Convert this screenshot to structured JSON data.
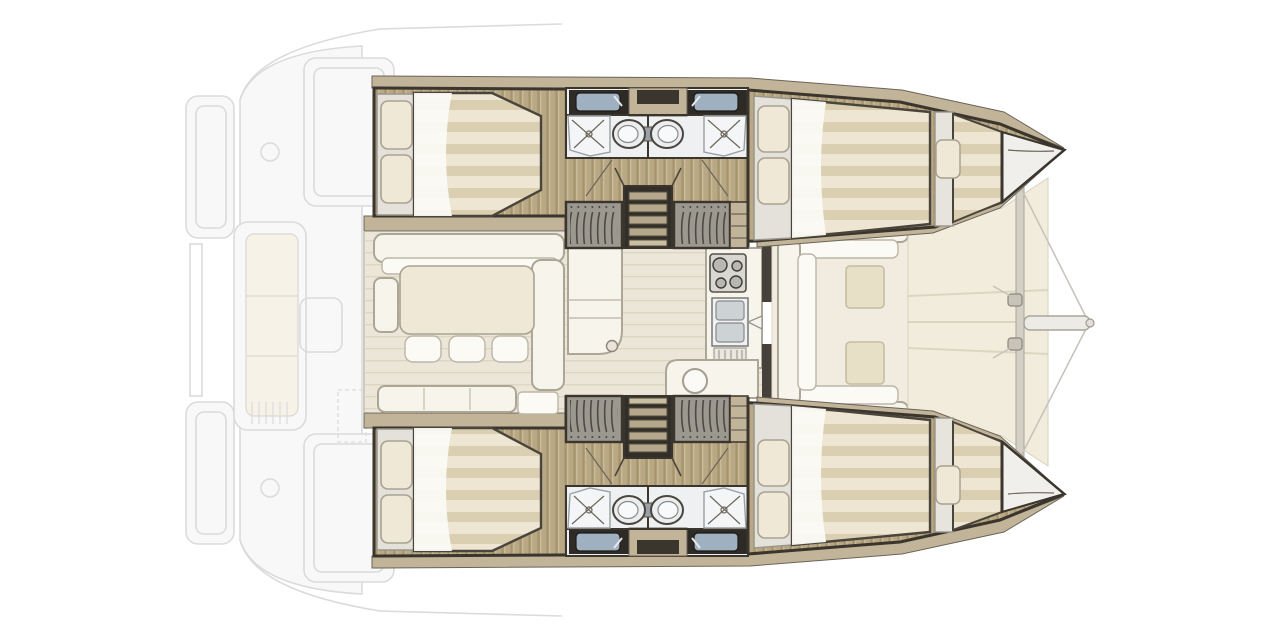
{
  "diagram": {
    "type": "boat floor plan",
    "subject": "sailing catamaran interior layout, overhead view, bow pointing right",
    "rendered_text": [],
    "features": {
      "hulls": [
        {
          "name": "port-hull-top",
          "contents": [
            "aft double cabin",
            "bathroom (sink, toilet, shower)",
            "hanging wardrobes",
            "companionway stairs",
            "forward double cabin",
            "bow berth"
          ]
        },
        {
          "name": "starboard-hull-bottom",
          "contents": [
            "aft double cabin",
            "bathroom (sink, toilet, shower)",
            "hanging wardrobes",
            "companionway stairs",
            "forward double cabin",
            "bow berth"
          ]
        }
      ],
      "bridgedeck": [
        "saloon L-sofa",
        "dining table",
        "three stools",
        "chaise bench",
        "side table",
        "galley island",
        "galley counter with stove, double sink, drainer, faucet",
        "nav seat with round stool"
      ],
      "exterior": [
        "faded aft cockpit deck",
        "transom steps",
        "aft bench with cushions",
        "forward cockpit U-seating with two cushions",
        "trampoline",
        "forward crossbeam",
        "bowsprit",
        "bridle lines"
      ]
    }
  },
  "palette": {
    "outline": "#3a352d",
    "wood": "#b9a885",
    "wood_dark": "#a6946e",
    "deck_tan": "#c2b499",
    "plank_floor": "#ece6d8",
    "cream": "#efe8d6",
    "mattress_light": "#eee6d2",
    "mattress_dark": "#dbcfb2",
    "white_furn": "#f7f4ec",
    "furn_stroke": "#aca696",
    "bath_floor": "#eef0f1",
    "counter_dark": "#2e2a25",
    "basin_blue": "#9fb0c1",
    "fixture_gray": "#ecedef",
    "trampoline": "#f2ecdc",
    "cushion": "#e7dfc6",
    "stairs_dark": "#322e28",
    "wardrobe_gray": "#9b988f",
    "faded": "#c2c2c7",
    "background": "#ffffff"
  }
}
